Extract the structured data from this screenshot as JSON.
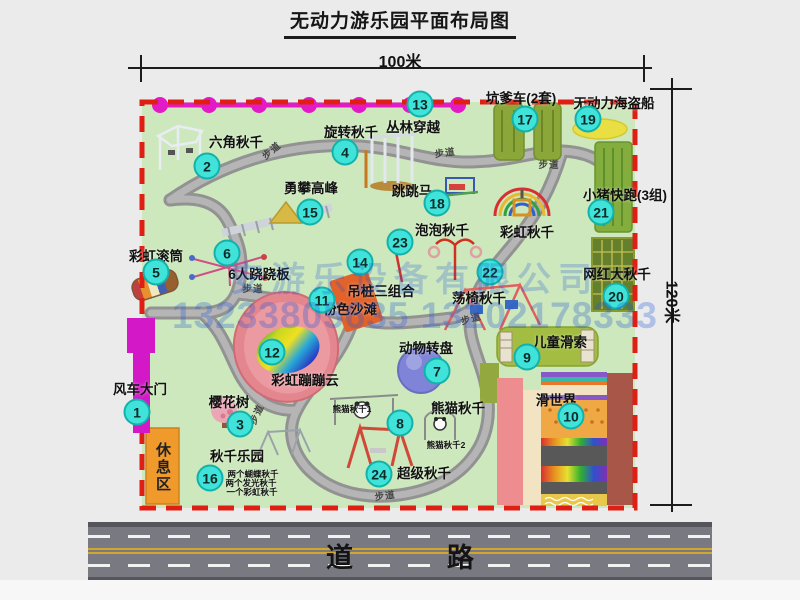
{
  "title": "无动力游乐园平面布局图",
  "dimensions": {
    "width_label": "100米",
    "height_label": "120米"
  },
  "road": {
    "label": "道 路"
  },
  "watermark": {
    "company": "安游乐设备有限公司",
    "phones": "13233805635 13202178333"
  },
  "rest_area_label": "休息区",
  "colors": {
    "map_green": "#cde8bc",
    "border_red": "#df1f14",
    "badge_cyan": "#3fe3da",
    "magenta": "#e21cc6",
    "path_gray": "#9c9c9c",
    "rest_orange": "#f09a2c",
    "road_gray": "#797982",
    "road_yellow": "#d2a62c",
    "pink_beach": "#e4868e",
    "purple_disc": "#8084d8"
  },
  "map": {
    "items": [
      {
        "num": "1",
        "label": "风车大门",
        "bx": 137,
        "by": 412,
        "lx": 140,
        "ly": 388
      },
      {
        "num": "2",
        "label": "六角秋千",
        "bx": 207,
        "by": 166,
        "lx": 236,
        "ly": 141
      },
      {
        "num": "3",
        "label": "樱花树",
        "bx": 240,
        "by": 424,
        "lx": 229,
        "ly": 401
      },
      {
        "num": "4",
        "label": "旋转秋千",
        "bx": 345,
        "by": 152,
        "lx": 351,
        "ly": 131
      },
      {
        "num": "5",
        "label": "彩虹滚筒",
        "bx": 156,
        "by": 272,
        "lx": 156,
        "ly": 255
      },
      {
        "num": "6",
        "label": "6人跷跷板",
        "bx": 227,
        "by": 253,
        "lx": 259,
        "ly": 273
      },
      {
        "num": "7",
        "label": "动物转盘",
        "bx": 437,
        "by": 371,
        "lx": 426,
        "ly": 347
      },
      {
        "num": "8",
        "label": "熊猫秋千",
        "bx": 400,
        "by": 423,
        "lx": 458,
        "ly": 407
      },
      {
        "num": "9",
        "label": "儿童滑索",
        "bx": 527,
        "by": 357,
        "lx": 560,
        "ly": 341
      },
      {
        "num": "10",
        "label": "滑世界",
        "bx": 571,
        "by": 416,
        "lx": 556,
        "ly": 399
      },
      {
        "num": "11",
        "label": "粉色沙滩",
        "bx": 322,
        "by": 300,
        "lx": 350,
        "ly": 308
      },
      {
        "num": "12",
        "label": "彩虹蹦蹦云",
        "bx": 272,
        "by": 352,
        "lx": 305,
        "ly": 379
      },
      {
        "num": "13",
        "label": "丛林穿越",
        "bx": 420,
        "by": 104,
        "lx": 413,
        "ly": 126
      },
      {
        "num": "14",
        "label": "吊桩三组合",
        "bx": 360,
        "by": 262,
        "lx": 381,
        "ly": 290
      },
      {
        "num": "15",
        "label": "勇攀高峰",
        "bx": 310,
        "by": 212,
        "lx": 311,
        "ly": 187
      },
      {
        "num": "16",
        "label": "秋千乐园",
        "bx": 210,
        "by": 478,
        "lx": 237,
        "ly": 455
      },
      {
        "num": "17",
        "label": "坑爹车(2套)",
        "bx": 525,
        "by": 119,
        "lx": 521,
        "ly": 97
      },
      {
        "num": "18",
        "label": "跳跳马",
        "bx": 437,
        "by": 203,
        "lx": 412,
        "ly": 190
      },
      {
        "num": "19",
        "label": "无动力海盗船",
        "bx": 588,
        "by": 119,
        "lx": 614,
        "ly": 102
      },
      {
        "num": "20",
        "label": "网红大秋千",
        "bx": 616,
        "by": 296,
        "lx": 617,
        "ly": 273
      },
      {
        "num": "21",
        "label": "小猪快跑(3组)",
        "bx": 601,
        "by": 212,
        "lx": 625,
        "ly": 194
      },
      {
        "num": "22",
        "label": "荡椅秋千",
        "bx": 490,
        "by": 272,
        "lx": 479,
        "ly": 297
      },
      {
        "num": "23",
        "label": "泡泡秋千",
        "bx": 400,
        "by": 242,
        "lx": 442,
        "ly": 229
      },
      {
        "num": "24",
        "label": "超级秋千",
        "bx": 379,
        "by": 474,
        "lx": 424,
        "ly": 472
      }
    ],
    "extra_labels": [
      {
        "text": "彩虹秋千",
        "x": 527,
        "y": 231,
        "name": "label-rainbow-swing"
      },
      {
        "text": "熊猫秋千1",
        "x": 352,
        "y": 409,
        "small": true,
        "name": "label-panda-swing-1"
      },
      {
        "text": "熊猫秋千2",
        "x": 446,
        "y": 445,
        "small": true,
        "name": "label-panda-swing-2"
      },
      {
        "text": "两个蝴蝶秋千",
        "x": 253,
        "y": 474,
        "small": true,
        "name": "label-swing-note-1"
      },
      {
        "text": "两个发光秋千",
        "x": 251,
        "y": 483,
        "small": true,
        "name": "label-swing-note-2"
      },
      {
        "text": "一个彩虹秋千",
        "x": 252,
        "y": 492,
        "small": true,
        "name": "label-swing-note-3"
      }
    ],
    "path_labels": [
      {
        "text": "步道",
        "x": 271,
        "y": 150,
        "rot": -40
      },
      {
        "text": "步道",
        "x": 445,
        "y": 152,
        "rot": -8
      },
      {
        "text": "步道",
        "x": 549,
        "y": 164,
        "rot": 0
      },
      {
        "text": "步道",
        "x": 253,
        "y": 288,
        "rot": 0
      },
      {
        "text": "步道",
        "x": 471,
        "y": 318,
        "rot": -15
      },
      {
        "text": "步道",
        "x": 256,
        "y": 414,
        "rot": -65
      },
      {
        "text": "步道",
        "x": 385,
        "y": 495,
        "rot": -8
      }
    ]
  }
}
